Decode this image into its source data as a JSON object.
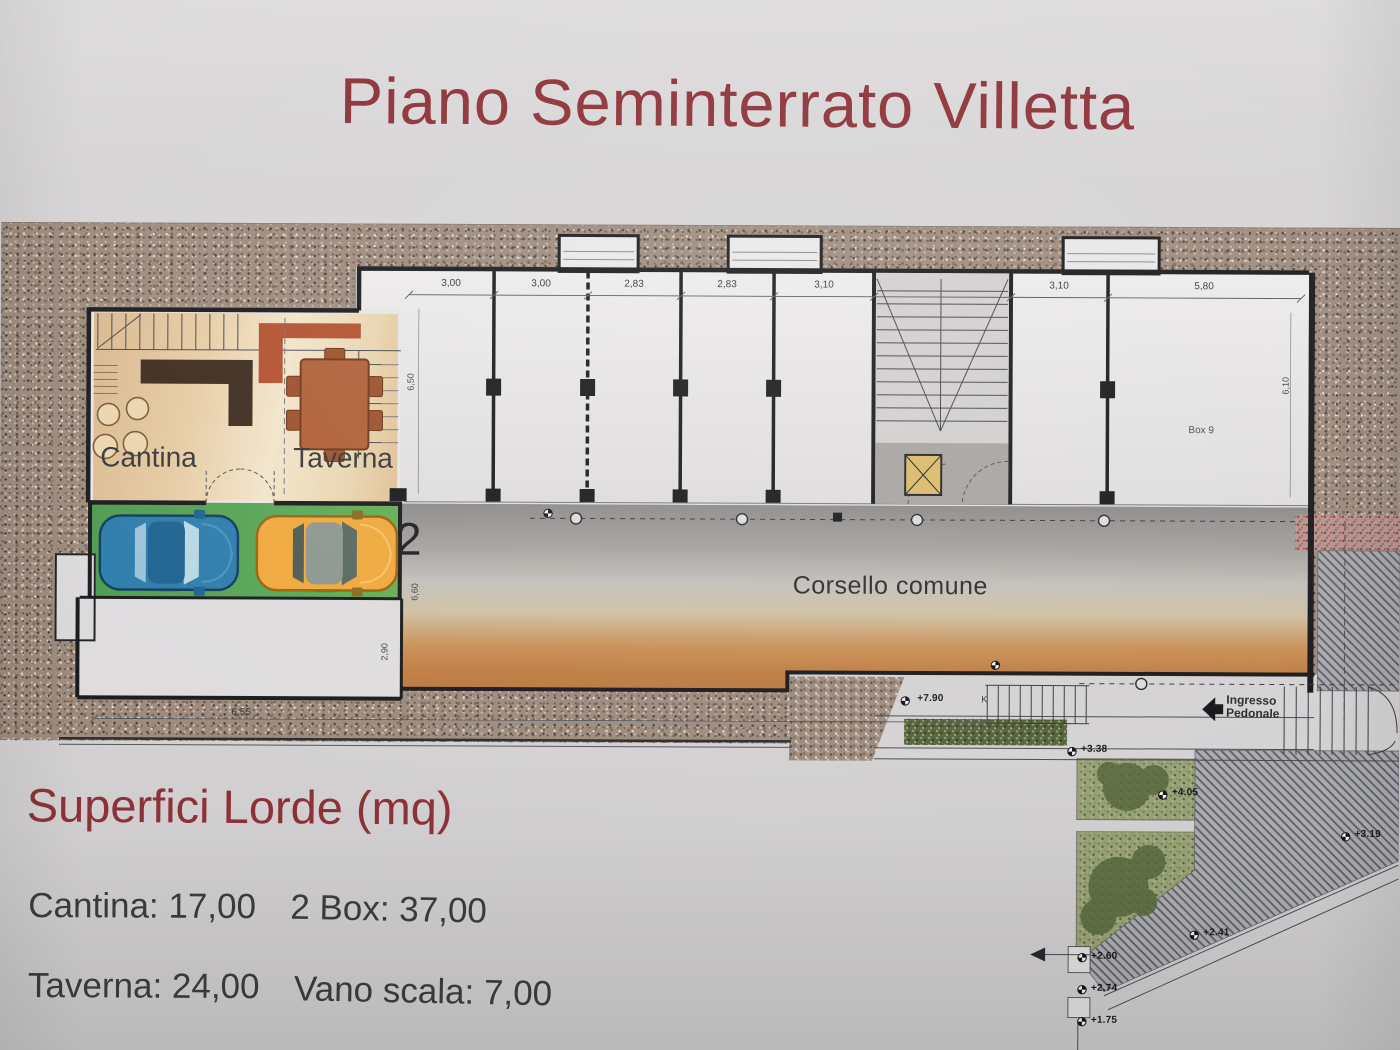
{
  "title": {
    "text": "Piano Seminterrato Villetta"
  },
  "plan": {
    "rooms": {
      "cantina": "Cantina",
      "taverna": "Taverna"
    },
    "corsello": "Corsello comune",
    "box9": "Box 9",
    "garage_number": "2",
    "ingresso": "Ingresso Pedonale",
    "stair_letter": "K",
    "dims_top": [
      "3,00",
      "3,00",
      "2,83",
      "2,83",
      "3,10",
      "3,10",
      "5,80"
    ],
    "dims_side": {
      "garage_depth": "6,50",
      "box9_depth": "6,10",
      "corsello_width": "6,60",
      "room_depth": "2,90",
      "room_width": "6,55"
    },
    "elevations": {
      "walkway": "+7.90",
      "garden_top": "+3.38",
      "garden_mid": "+4.05",
      "path_right": "+3.19",
      "path_mid": "+2.41",
      "tip_1": "+2.60",
      "tip_2": "+2.74",
      "tip_3": "+1.75"
    }
  },
  "legend": {
    "heading": "Superfici Lorde (mq)",
    "entries": [
      {
        "label": "Cantina",
        "value": "17,00",
        "text": "Cantina: 17,00"
      },
      {
        "label": "2 Box",
        "value": "37,00",
        "text": "2 Box: 37,00"
      },
      {
        "label": "Taverna",
        "value": "24,00",
        "text": "Taverna: 24,00"
      },
      {
        "label": "Vano scala",
        "value": "7,00",
        "text": "Vano scala: 7,00"
      }
    ]
  },
  "colors": {
    "title_red": "#8d3138",
    "terrain": "#9e8b7e",
    "corsello_orange": "#bf7d42",
    "garage_green": "#58a557",
    "car_blue": "#2e7dad",
    "car_yellow": "#f0a93c",
    "room_beige": "#e7cda6",
    "garden_olive": "#98a176"
  }
}
